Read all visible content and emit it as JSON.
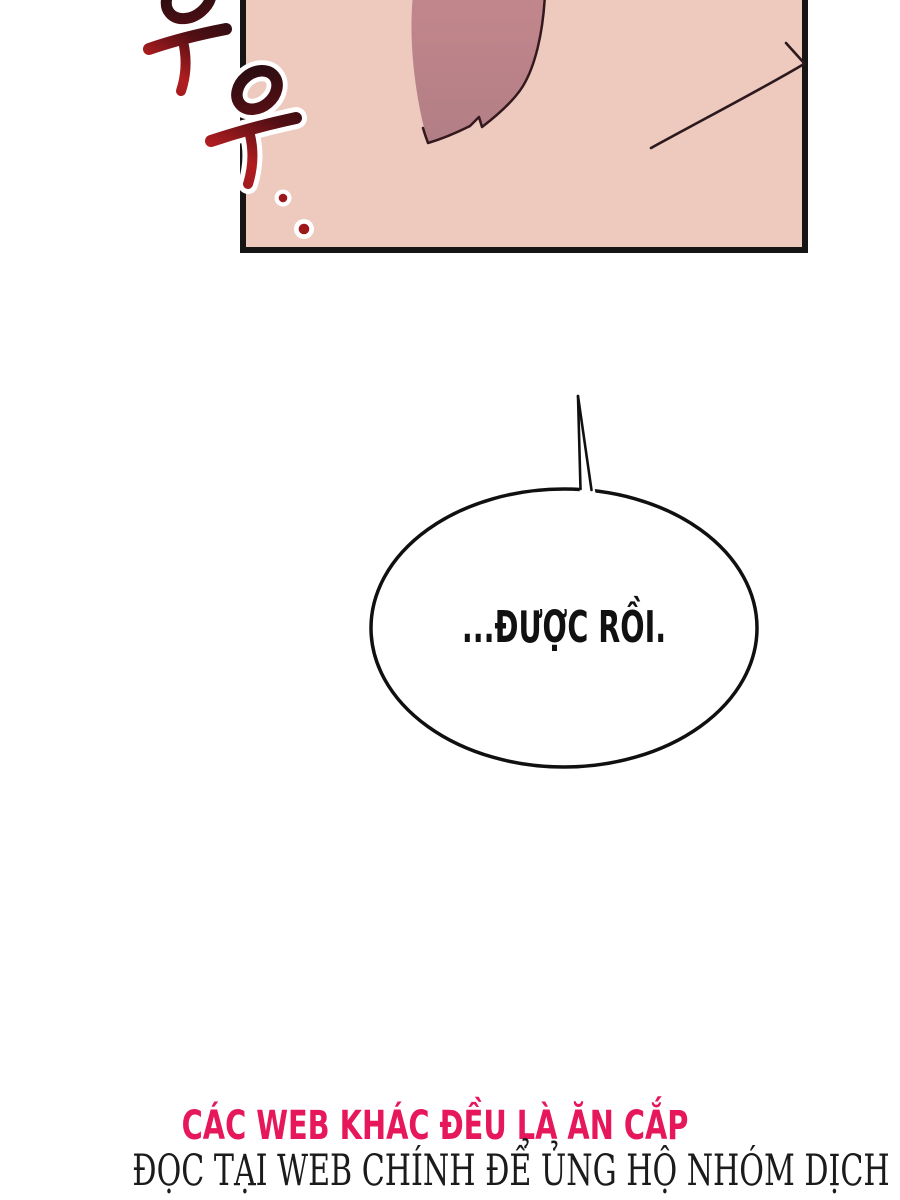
{
  "page": {
    "kind": "webtoon-comic-page",
    "background_color": "#ffffff"
  },
  "panel": {
    "background_color": "#edc9be",
    "border_color": "#151515",
    "hair_color_top": "#c2878c",
    "hair_color_bottom": "#b27e85",
    "line_color": "#33191d",
    "sfx_text": "우우..",
    "sfx_colors": {
      "dark": "#150c0f",
      "red": "#b01d20",
      "halo": "#ffffff"
    }
  },
  "speech_bubble": {
    "text": "...ĐƯỢC RỒI.",
    "fill_color": "#ffffff",
    "stroke_color": "#101010",
    "text_color": "#111111"
  },
  "footer": {
    "line1": "CÁC WEB KHÁC ĐỀU LÀ ĂN CẮP",
    "line1_color": "#e6175a",
    "line2": "ĐỌC TẠI WEB CHÍNH ĐỂ ỦNG HỘ NHÓM DỊCH",
    "line2_color": "#1b1b1b"
  }
}
